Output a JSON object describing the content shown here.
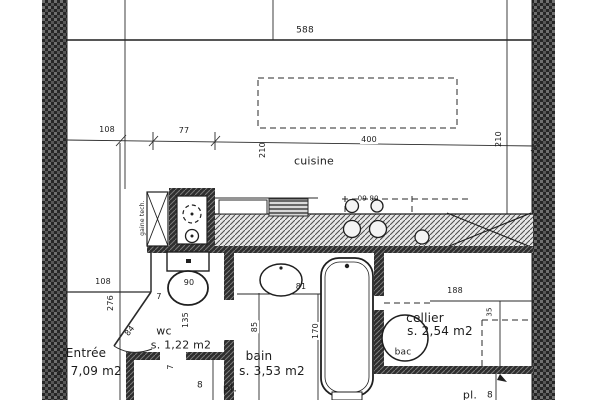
{
  "plan": {
    "rooms": {
      "cuisine": {
        "name": "cuisine"
      },
      "entree": {
        "name": "Entrée",
        "area": "s. 7,09 m2"
      },
      "wc": {
        "name": "wc",
        "area": "s. 1,22 m2"
      },
      "bain": {
        "name": "bain",
        "area": "s. 3,53 m2"
      },
      "cellier": {
        "name": "cellier",
        "area": "s. 2,54 m2"
      },
      "placard": {
        "name": "pl."
      },
      "placard_bottom": {
        "name": "pl."
      }
    },
    "fixtures": {
      "bac_label": "bac",
      "duct_label": "gaine tech.",
      "hob_label": "08 60"
    },
    "dimensions": {
      "d588": "588",
      "d108_top": "108",
      "d77": "77",
      "d400": "400",
      "d210_left": "210",
      "d210_right": "210",
      "d108_left": "108",
      "d276": "276",
      "d84": "84",
      "d7_wc": "7",
      "d90": "90",
      "d135": "135",
      "d7_pl": "7",
      "d8_pl": "8",
      "d81": "81",
      "d85": "85",
      "d170": "170",
      "d188": "188",
      "d35": "35",
      "d8_bottom": "8"
    },
    "colors": {
      "ink": "#1f1f1f",
      "paper": "#ffffff"
    }
  }
}
